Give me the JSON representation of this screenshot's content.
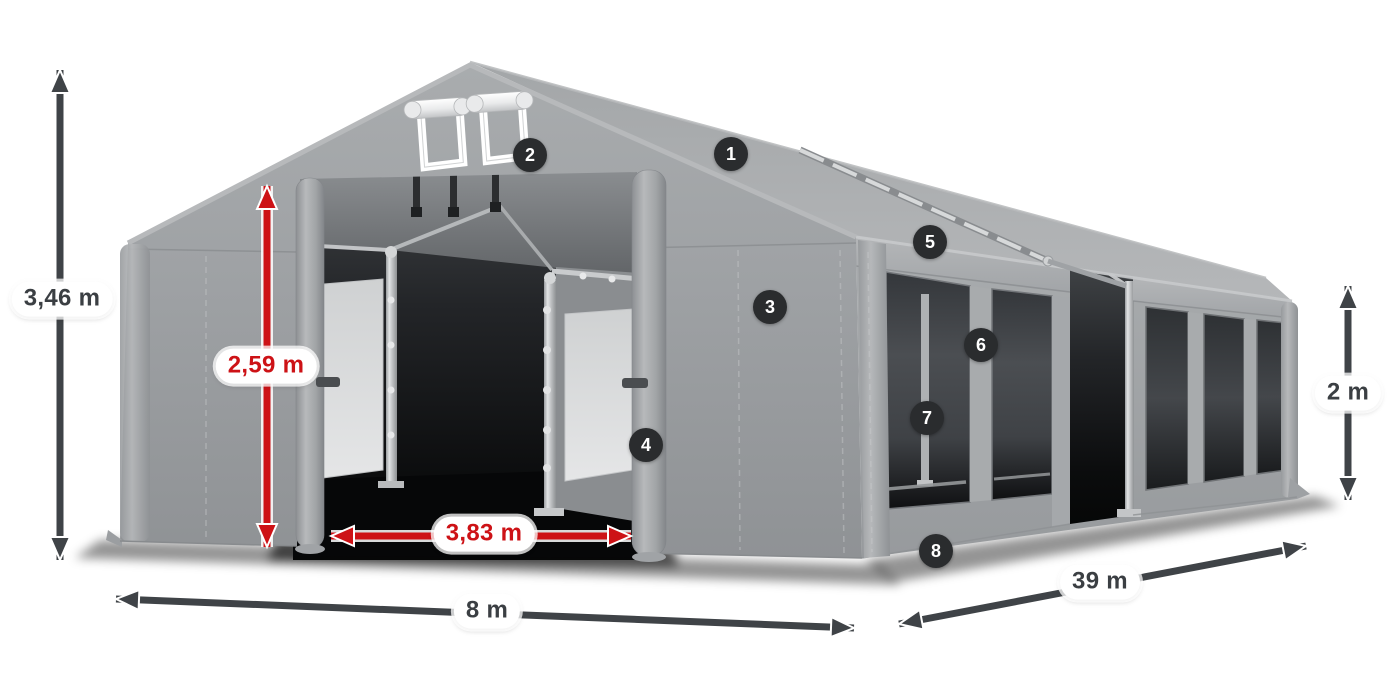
{
  "colors": {
    "accent_red": "#cd1216",
    "arrow_dark": "#3f4347",
    "badge_bg": "#2a2c2e",
    "label_dark": "#3b3f43",
    "fabric_gray": "#a2a5a8",
    "window_dark": "#3a3d41",
    "background": "#ffffff"
  },
  "dimensions": {
    "total_height": {
      "label": "3,46 m",
      "color": "dark"
    },
    "entrance_height": {
      "label": "2,59 m",
      "color": "red"
    },
    "entrance_width": {
      "label": "3,83 m",
      "color": "red"
    },
    "width": {
      "label": "8 m",
      "color": "dark"
    },
    "length": {
      "label": "39 m",
      "color": "dark"
    },
    "side_height": {
      "label": "2 m",
      "color": "dark"
    }
  },
  "callouts": [
    {
      "number": "1"
    },
    {
      "number": "2"
    },
    {
      "number": "3"
    },
    {
      "number": "4"
    },
    {
      "number": "5"
    },
    {
      "number": "6"
    },
    {
      "number": "7"
    },
    {
      "number": "8"
    }
  ]
}
